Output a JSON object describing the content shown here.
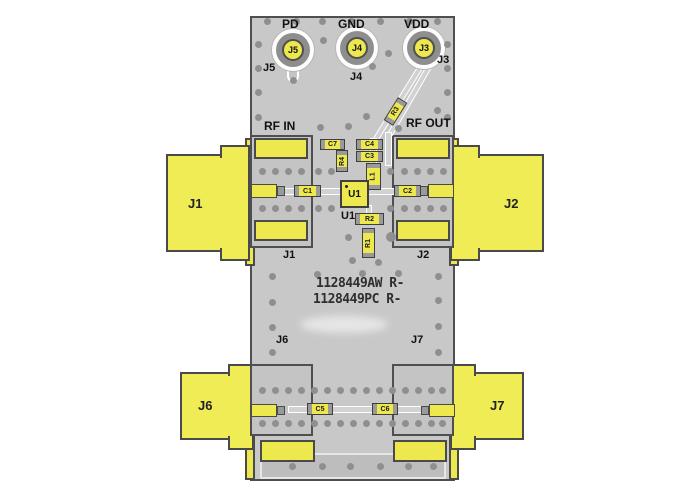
{
  "colors": {
    "pcb_gray": "#c8c8c8",
    "copper_yellow": "#ece84e",
    "via_gray": "#8f8f8f",
    "outline": "#4a4a4a"
  },
  "top_pads": [
    {
      "signal": "PD",
      "ref": "J5"
    },
    {
      "signal": "GND",
      "ref": "J4"
    },
    {
      "signal": "VDD",
      "ref": "J3"
    }
  ],
  "rf_labels": {
    "input": "RF IN",
    "output": "RF OUT"
  },
  "connectors": {
    "j1": "J1",
    "j2": "J2",
    "j6": "J6",
    "j7": "J7"
  },
  "silkscreen": {
    "j1": "J1",
    "j2": "J2",
    "j3": "J3",
    "j4": "J4",
    "j5": "J5",
    "j6": "J6",
    "j7": "J7",
    "u1": "U1"
  },
  "components": {
    "u1": "U1",
    "c1": "C1",
    "c2": "C2",
    "c3": "C3",
    "c4": "C4",
    "c5": "C5",
    "c6": "C6",
    "c7": "C7",
    "r1": "R1",
    "r2": "R2",
    "r3": "R3",
    "r4": "R4",
    "l1": "L1"
  },
  "part_numbers": {
    "line1": "1128449AW R-",
    "line2": "1128449PC R-"
  }
}
